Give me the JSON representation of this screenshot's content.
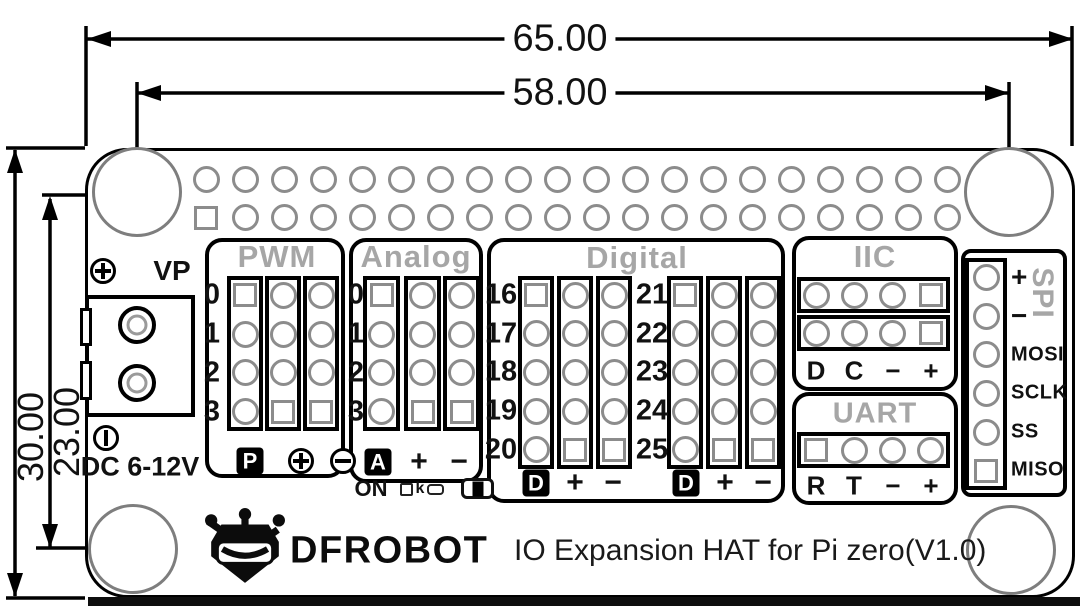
{
  "drawing": {
    "dimensions": {
      "overall_width_mm": "65.00",
      "hole_pitch_width_mm": "58.00",
      "overall_height_mm": "30.00",
      "hole_pitch_height_mm": "23.00"
    }
  },
  "board": {
    "header": {
      "rows": 2,
      "cols": 20,
      "pin1_shape": "square"
    },
    "power": {
      "vp_label": "VP",
      "dc_label": "DC 6-12V"
    },
    "switch": {
      "on_label": "ON",
      "k_label": "k"
    },
    "sections": {
      "pwm": {
        "title": "PWM",
        "row_labels": [
          "0",
          "1",
          "2",
          "3"
        ],
        "col_patterns": [
          [
            "square",
            "circle",
            "circle",
            "circle"
          ],
          [
            "circle",
            "circle",
            "circle",
            "square"
          ],
          [
            "circle",
            "circle",
            "circle",
            "square"
          ]
        ],
        "bottom_labels": [
          {
            "style": "chip",
            "label": "P"
          },
          {
            "style": "circle-plus-icon",
            "label": "⊕"
          },
          {
            "style": "circle-minus-icon",
            "label": "⊖"
          }
        ]
      },
      "analog": {
        "title": "Analog",
        "row_labels": [
          "0",
          "1",
          "2",
          "3"
        ],
        "col_patterns": [
          [
            "square",
            "circle",
            "circle",
            "circle"
          ],
          [
            "circle",
            "circle",
            "circle",
            "square"
          ],
          [
            "circle",
            "circle",
            "circle",
            "square"
          ]
        ],
        "bottom_labels": [
          {
            "style": "chip",
            "label": "A"
          },
          {
            "style": "text",
            "label": "+"
          },
          {
            "style": "text",
            "label": "−"
          }
        ]
      },
      "digital": {
        "title": "Digital",
        "groups": [
          {
            "row_labels": [
              "16",
              "17",
              "18",
              "19",
              "20"
            ],
            "col_patterns": [
              [
                "square",
                "circle",
                "circle",
                "circle",
                "circle"
              ],
              [
                "circle",
                "circle",
                "circle",
                "circle",
                "square"
              ],
              [
                "circle",
                "circle",
                "circle",
                "circle",
                "square"
              ]
            ],
            "bottom_labels": [
              {
                "style": "chip",
                "label": "D"
              },
              {
                "style": "text",
                "label": "+"
              },
              {
                "style": "text",
                "label": "−"
              }
            ]
          },
          {
            "row_labels": [
              "21",
              "22",
              "23",
              "24",
              "25"
            ],
            "col_patterns": [
              [
                "square",
                "circle",
                "circle",
                "circle",
                "circle"
              ],
              [
                "circle",
                "circle",
                "circle",
                "circle",
                "square"
              ],
              [
                "circle",
                "circle",
                "circle",
                "circle",
                "square"
              ]
            ],
            "bottom_labels": [
              {
                "style": "chip",
                "label": "D"
              },
              {
                "style": "text",
                "label": "+"
              },
              {
                "style": "text",
                "label": "−"
              }
            ]
          }
        ]
      },
      "iic": {
        "title": "IIC",
        "row_patterns": [
          [
            "circle",
            "circle",
            "circle",
            "square"
          ],
          [
            "circle",
            "circle",
            "circle",
            "square"
          ]
        ],
        "pin_labels": [
          "D",
          "C",
          "−",
          "+"
        ]
      },
      "uart": {
        "title": "UART",
        "row_patterns": [
          [
            "square",
            "circle",
            "circle",
            "circle"
          ]
        ],
        "pin_labels": [
          "R",
          "T",
          "−",
          "+"
        ]
      },
      "spi": {
        "title": "SPI",
        "pattern": [
          "circle",
          "circle",
          "circle",
          "circle",
          "circle",
          "square"
        ],
        "pin_labels": [
          "+",
          "−",
          "MOSI",
          "SCLK",
          "SS",
          "MISO"
        ]
      }
    },
    "footer": {
      "brand": "DFROBOT",
      "product_title": "IO Expansion HAT for Pi zero(V1.0)"
    }
  },
  "colors": {
    "line": "#000000",
    "pad_outline": "#8c8c8c",
    "title_gray": "#a6a6a6"
  }
}
